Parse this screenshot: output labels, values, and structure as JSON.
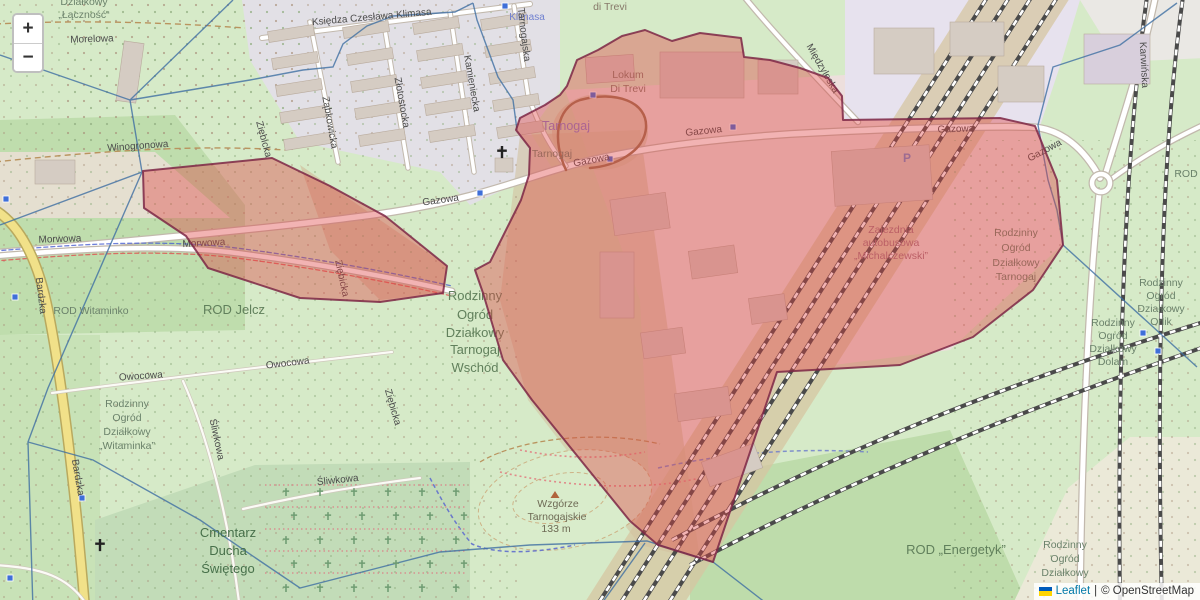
{
  "map": {
    "controls": {
      "zoom_in_label": "+",
      "zoom_out_label": "−"
    },
    "attribution": {
      "flag_icon": "ukraine-flag-icon",
      "leaflet_label": "Leaflet",
      "separator": "|",
      "osm_label": "© OpenStreetMap",
      "link_color": "#0078A8"
    },
    "colors": {
      "overlay_fill": "#df4040",
      "overlay_stroke": "#7c2745",
      "admin_boundary": "#3f6fa3",
      "road_secondary_yellow": "#f1e189",
      "transit_icon_blue": "#3f6fd8"
    },
    "labels": [
      [
        "Działkowy",
        84,
        5,
        0,
        "rod"
      ],
      [
        "„Łączność“",
        84,
        18,
        0,
        "rod"
      ],
      [
        "Morelowa",
        92,
        42,
        -2,
        "road"
      ],
      [
        "Winogronowa",
        138,
        149,
        -4,
        "road"
      ],
      [
        "Księdza Czesława Klimasa",
        372,
        20,
        -5,
        "road"
      ],
      [
        "Klimasa",
        527,
        20,
        0,
        "transit"
      ],
      [
        "di Trevi",
        610,
        10,
        0,
        "bldg"
      ],
      [
        "Lokum",
        628,
        78,
        0,
        "bldg"
      ],
      [
        "Di Trevi",
        628,
        92,
        0,
        "bldg"
      ],
      [
        "Tarnogaj",
        566,
        130,
        0,
        "place"
      ],
      [
        "Tarnogaj",
        552,
        157,
        0,
        "rod"
      ],
      [
        "Gazowa",
        441,
        203,
        -8,
        "road"
      ],
      [
        "Gazowa",
        592,
        163,
        -11,
        "road"
      ],
      [
        "Gazowa",
        704,
        134,
        -6,
        "road"
      ],
      [
        "Gazowa",
        956,
        132,
        -2,
        "road"
      ],
      [
        "Gazowa",
        1046,
        153,
        -28,
        "road"
      ],
      [
        "Morwowa",
        60,
        242,
        -2,
        "road"
      ],
      [
        "Morwowa",
        204,
        246,
        -3,
        "road"
      ],
      [
        "Ząbkowicka",
        327,
        123,
        80,
        "road"
      ],
      [
        "Złotostocka",
        399,
        103,
        80,
        "road"
      ],
      [
        "Kamieniecka",
        469,
        84,
        80,
        "road"
      ],
      [
        "Tarnogajska",
        521,
        35,
        83,
        "road"
      ],
      [
        "Ziębicka",
        261,
        140,
        75,
        "road"
      ],
      [
        "Ziębicka",
        339,
        279,
        78,
        "road"
      ],
      [
        "Ziębicka",
        390,
        408,
        74,
        "road"
      ],
      [
        "Międzyleska",
        820,
        70,
        60,
        "road"
      ],
      [
        "Karwińska",
        1141,
        65,
        87,
        "road"
      ],
      [
        "Bardzka",
        38,
        296,
        83,
        "road"
      ],
      [
        "Bardzka",
        75,
        478,
        80,
        "road"
      ],
      [
        "Owocowa",
        141,
        379,
        -4,
        "road"
      ],
      [
        "Owocowa",
        288,
        366,
        -7,
        "road"
      ],
      [
        "Śliwkowa",
        214,
        440,
        78,
        "road"
      ],
      [
        "Śliwkowa",
        338,
        483,
        -6,
        "road"
      ],
      [
        "ROD Witaminko",
        91,
        314,
        0,
        "rod"
      ],
      [
        "ROD Jelcz",
        234,
        314,
        0,
        "rod-lg"
      ],
      [
        "Rodzinny",
        475,
        300,
        0,
        "rod-lg"
      ],
      [
        "Ogród",
        475,
        319,
        0,
        "rod-lg"
      ],
      [
        "Działkowy",
        475,
        337,
        0,
        "rod-lg"
      ],
      [
        "Tarnogaj",
        475,
        354,
        0,
        "rod-lg"
      ],
      [
        "Wschód",
        475,
        372,
        0,
        "rod-lg"
      ],
      [
        "Rodzinny",
        127,
        407,
        0,
        "rod"
      ],
      [
        "Ogród",
        127,
        421,
        0,
        "rod"
      ],
      [
        "Działkowy",
        127,
        435,
        0,
        "rod"
      ],
      [
        "„Witaminka”",
        127,
        449,
        0,
        "rod"
      ],
      [
        "Cmentarz",
        228,
        537,
        0,
        "cem"
      ],
      [
        "Ducha",
        228,
        555,
        0,
        "cem"
      ],
      [
        "Świętego",
        228,
        573,
        0,
        "cem"
      ],
      [
        "Wzgórze",
        558,
        507,
        0,
        "hill"
      ],
      [
        "Tarnogajskie",
        557,
        520,
        0,
        "hill"
      ],
      [
        "133 m",
        556,
        532,
        0,
        "hill"
      ],
      [
        "Zajezdnia",
        891,
        233,
        0,
        "ind"
      ],
      [
        "autobusowa",
        891,
        246,
        0,
        "ind"
      ],
      [
        "„Michalczewski”",
        891,
        259,
        0,
        "ind"
      ],
      [
        "Rodzinny",
        1016,
        236,
        0,
        "rod"
      ],
      [
        "Ogród",
        1016,
        251,
        0,
        "rod"
      ],
      [
        "Działkowy",
        1016,
        266,
        0,
        "rod"
      ],
      [
        "Tarnogaj",
        1016,
        280,
        0,
        "rod"
      ],
      [
        "ROD",
        1186,
        177,
        0,
        "rod"
      ],
      [
        "Rodzinny",
        1161,
        286,
        0,
        "rod"
      ],
      [
        "Ogród",
        1161,
        299,
        0,
        "rod"
      ],
      [
        "Działkowy",
        1161,
        312,
        0,
        "rod"
      ],
      [
        "Orlik",
        1161,
        325,
        0,
        "rod"
      ],
      [
        "Rodzinny",
        1113,
        326,
        0,
        "rod"
      ],
      [
        "Ogród",
        1113,
        339,
        0,
        "rod"
      ],
      [
        "Działkowy",
        1113,
        352,
        0,
        "rod"
      ],
      [
        "Dolam",
        1113,
        365,
        0,
        "rod"
      ],
      [
        "ROD „Energetyk”",
        956,
        554,
        0,
        "rod-lg"
      ],
      [
        "Rodzinny",
        1065,
        548,
        0,
        "rod"
      ],
      [
        "Ogród",
        1065,
        562,
        0,
        "rod"
      ],
      [
        "Działkowy",
        1065,
        576,
        0,
        "rod"
      ]
    ],
    "icons": [
      [
        "bus-stop",
        480,
        193
      ],
      [
        "bus-stop",
        733,
        127
      ],
      [
        "bus-stop",
        610,
        159
      ],
      [
        "bus-stop",
        593,
        95
      ],
      [
        "bus-stop",
        1143,
        333
      ],
      [
        "bus-stop",
        1158,
        351
      ],
      [
        "bus-stop",
        82,
        498
      ],
      [
        "bus-stop",
        15,
        297
      ],
      [
        "bus-stop",
        6,
        199
      ],
      [
        "bus-stop",
        10,
        578
      ],
      [
        "bus-stop",
        505,
        6
      ],
      [
        "church-cross",
        502,
        152
      ],
      [
        "church-cross",
        100,
        545
      ],
      [
        "parking",
        907,
        162
      ],
      [
        "peak",
        555,
        495
      ]
    ]
  }
}
